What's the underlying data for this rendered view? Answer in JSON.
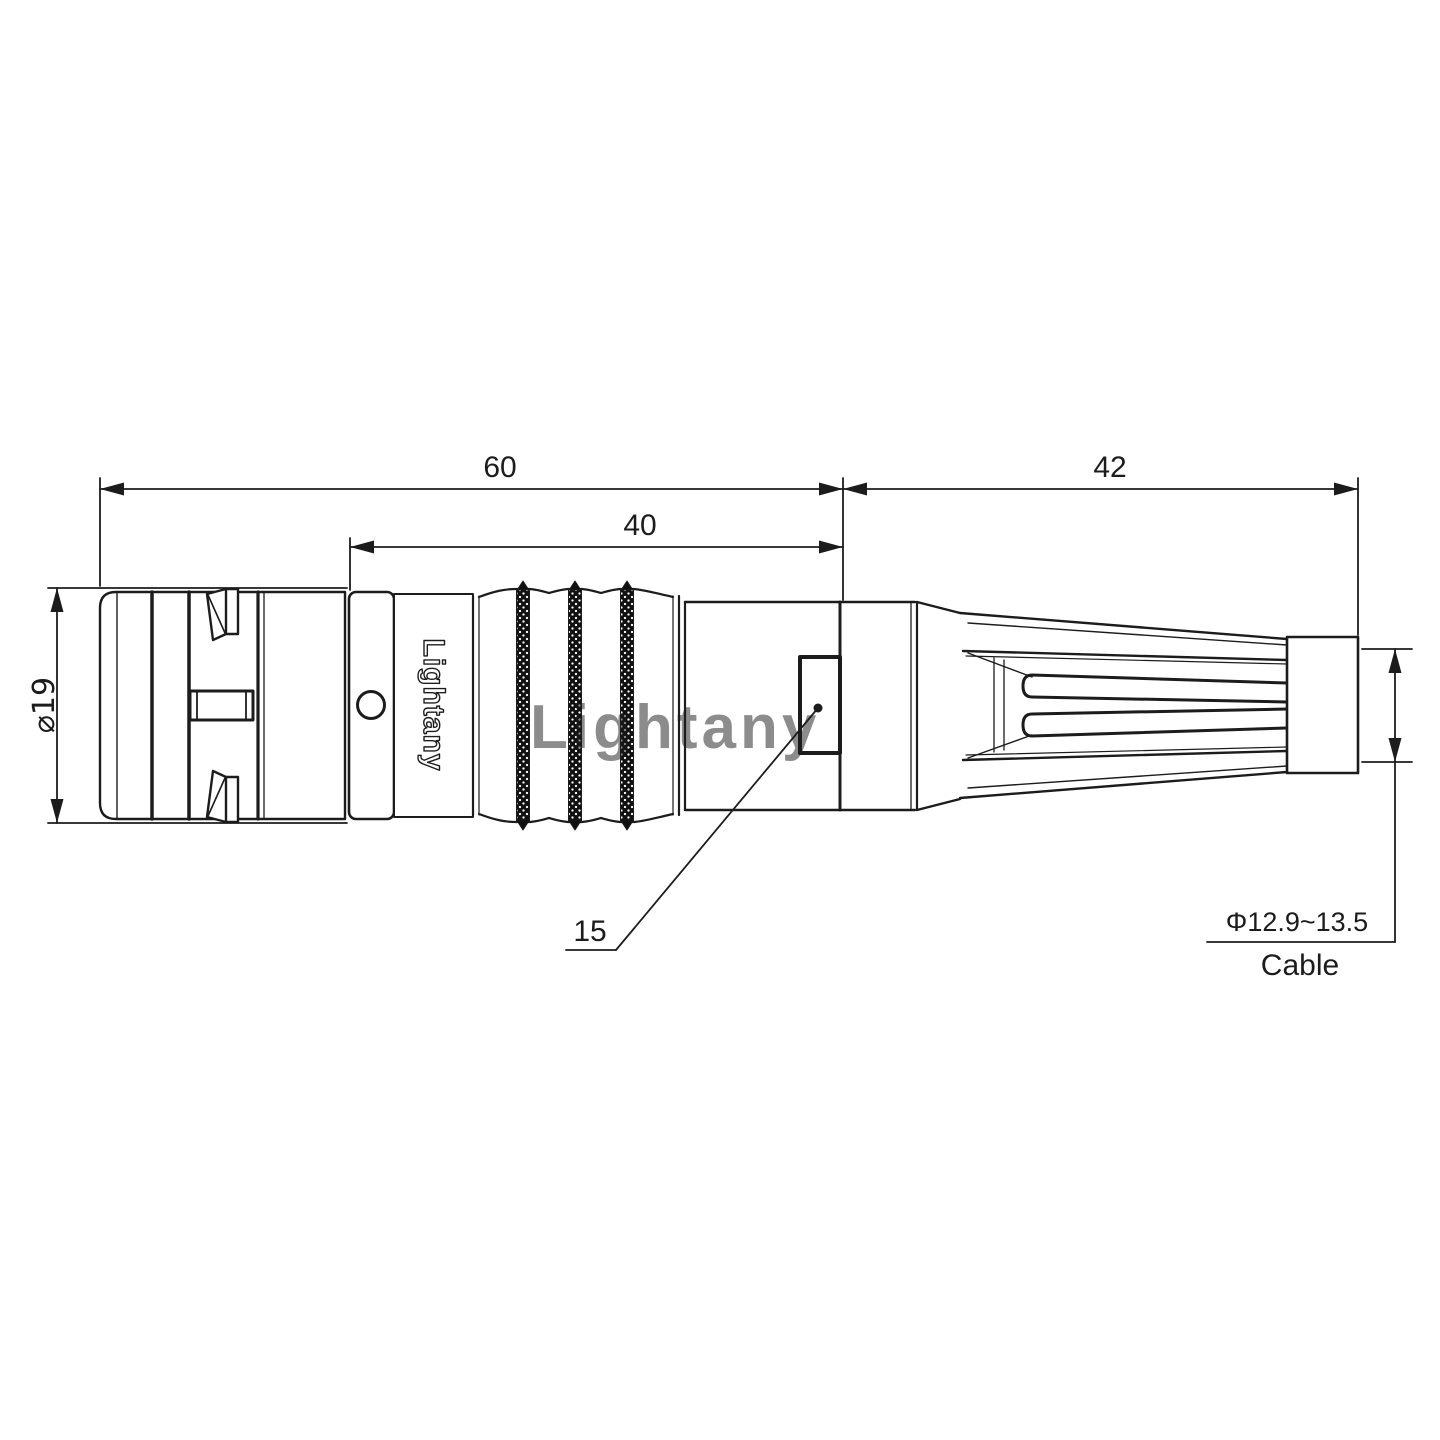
{
  "drawing": {
    "brand_text": "Lightany",
    "watermark": "Lightany",
    "dimensions": {
      "overall_length": "60",
      "mid_length": "40",
      "boot_length": "42",
      "front_diameter": "⌀19",
      "key_size": "15",
      "cable_diameter_range": "Φ12.9~13.5",
      "cable_label": "Cable"
    },
    "colors": {
      "line": "#1c1c1c",
      "watermark": "#efb9b9"
    }
  }
}
